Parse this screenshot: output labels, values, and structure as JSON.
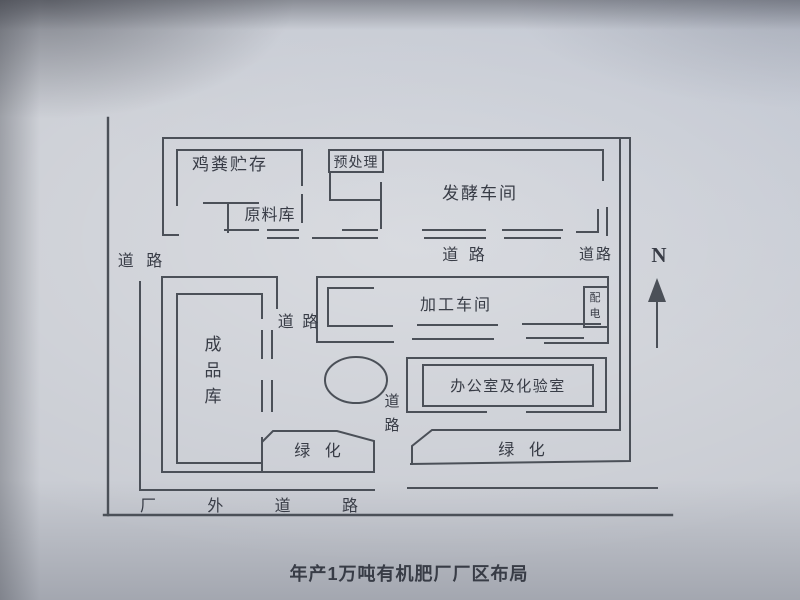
{
  "caption": "年产1万吨有机肥厂厂区布局",
  "compass_label": "N",
  "areas": {
    "chicken_manure_storage": "鸡粪贮存",
    "pretreatment": "预处理",
    "fermentation_workshop": "发酵车间",
    "raw_material_warehouse": "原料库",
    "processing_workshop": "加工车间",
    "power_distribution": "配电",
    "finished_product_warehouse": "成品库",
    "office_and_lab": "办公室及化验室",
    "greening_west": "绿 化",
    "greening_east": "绿 化"
  },
  "roads": {
    "west": "道 路",
    "north_center": "道 路",
    "north_east": "道路",
    "middle": "道 路",
    "south_vertical": "道路",
    "outside": "厂 外 道 路"
  },
  "colors": {
    "ink": "#4b5058",
    "text": "#383c46",
    "paper": "#c9ccd3"
  }
}
